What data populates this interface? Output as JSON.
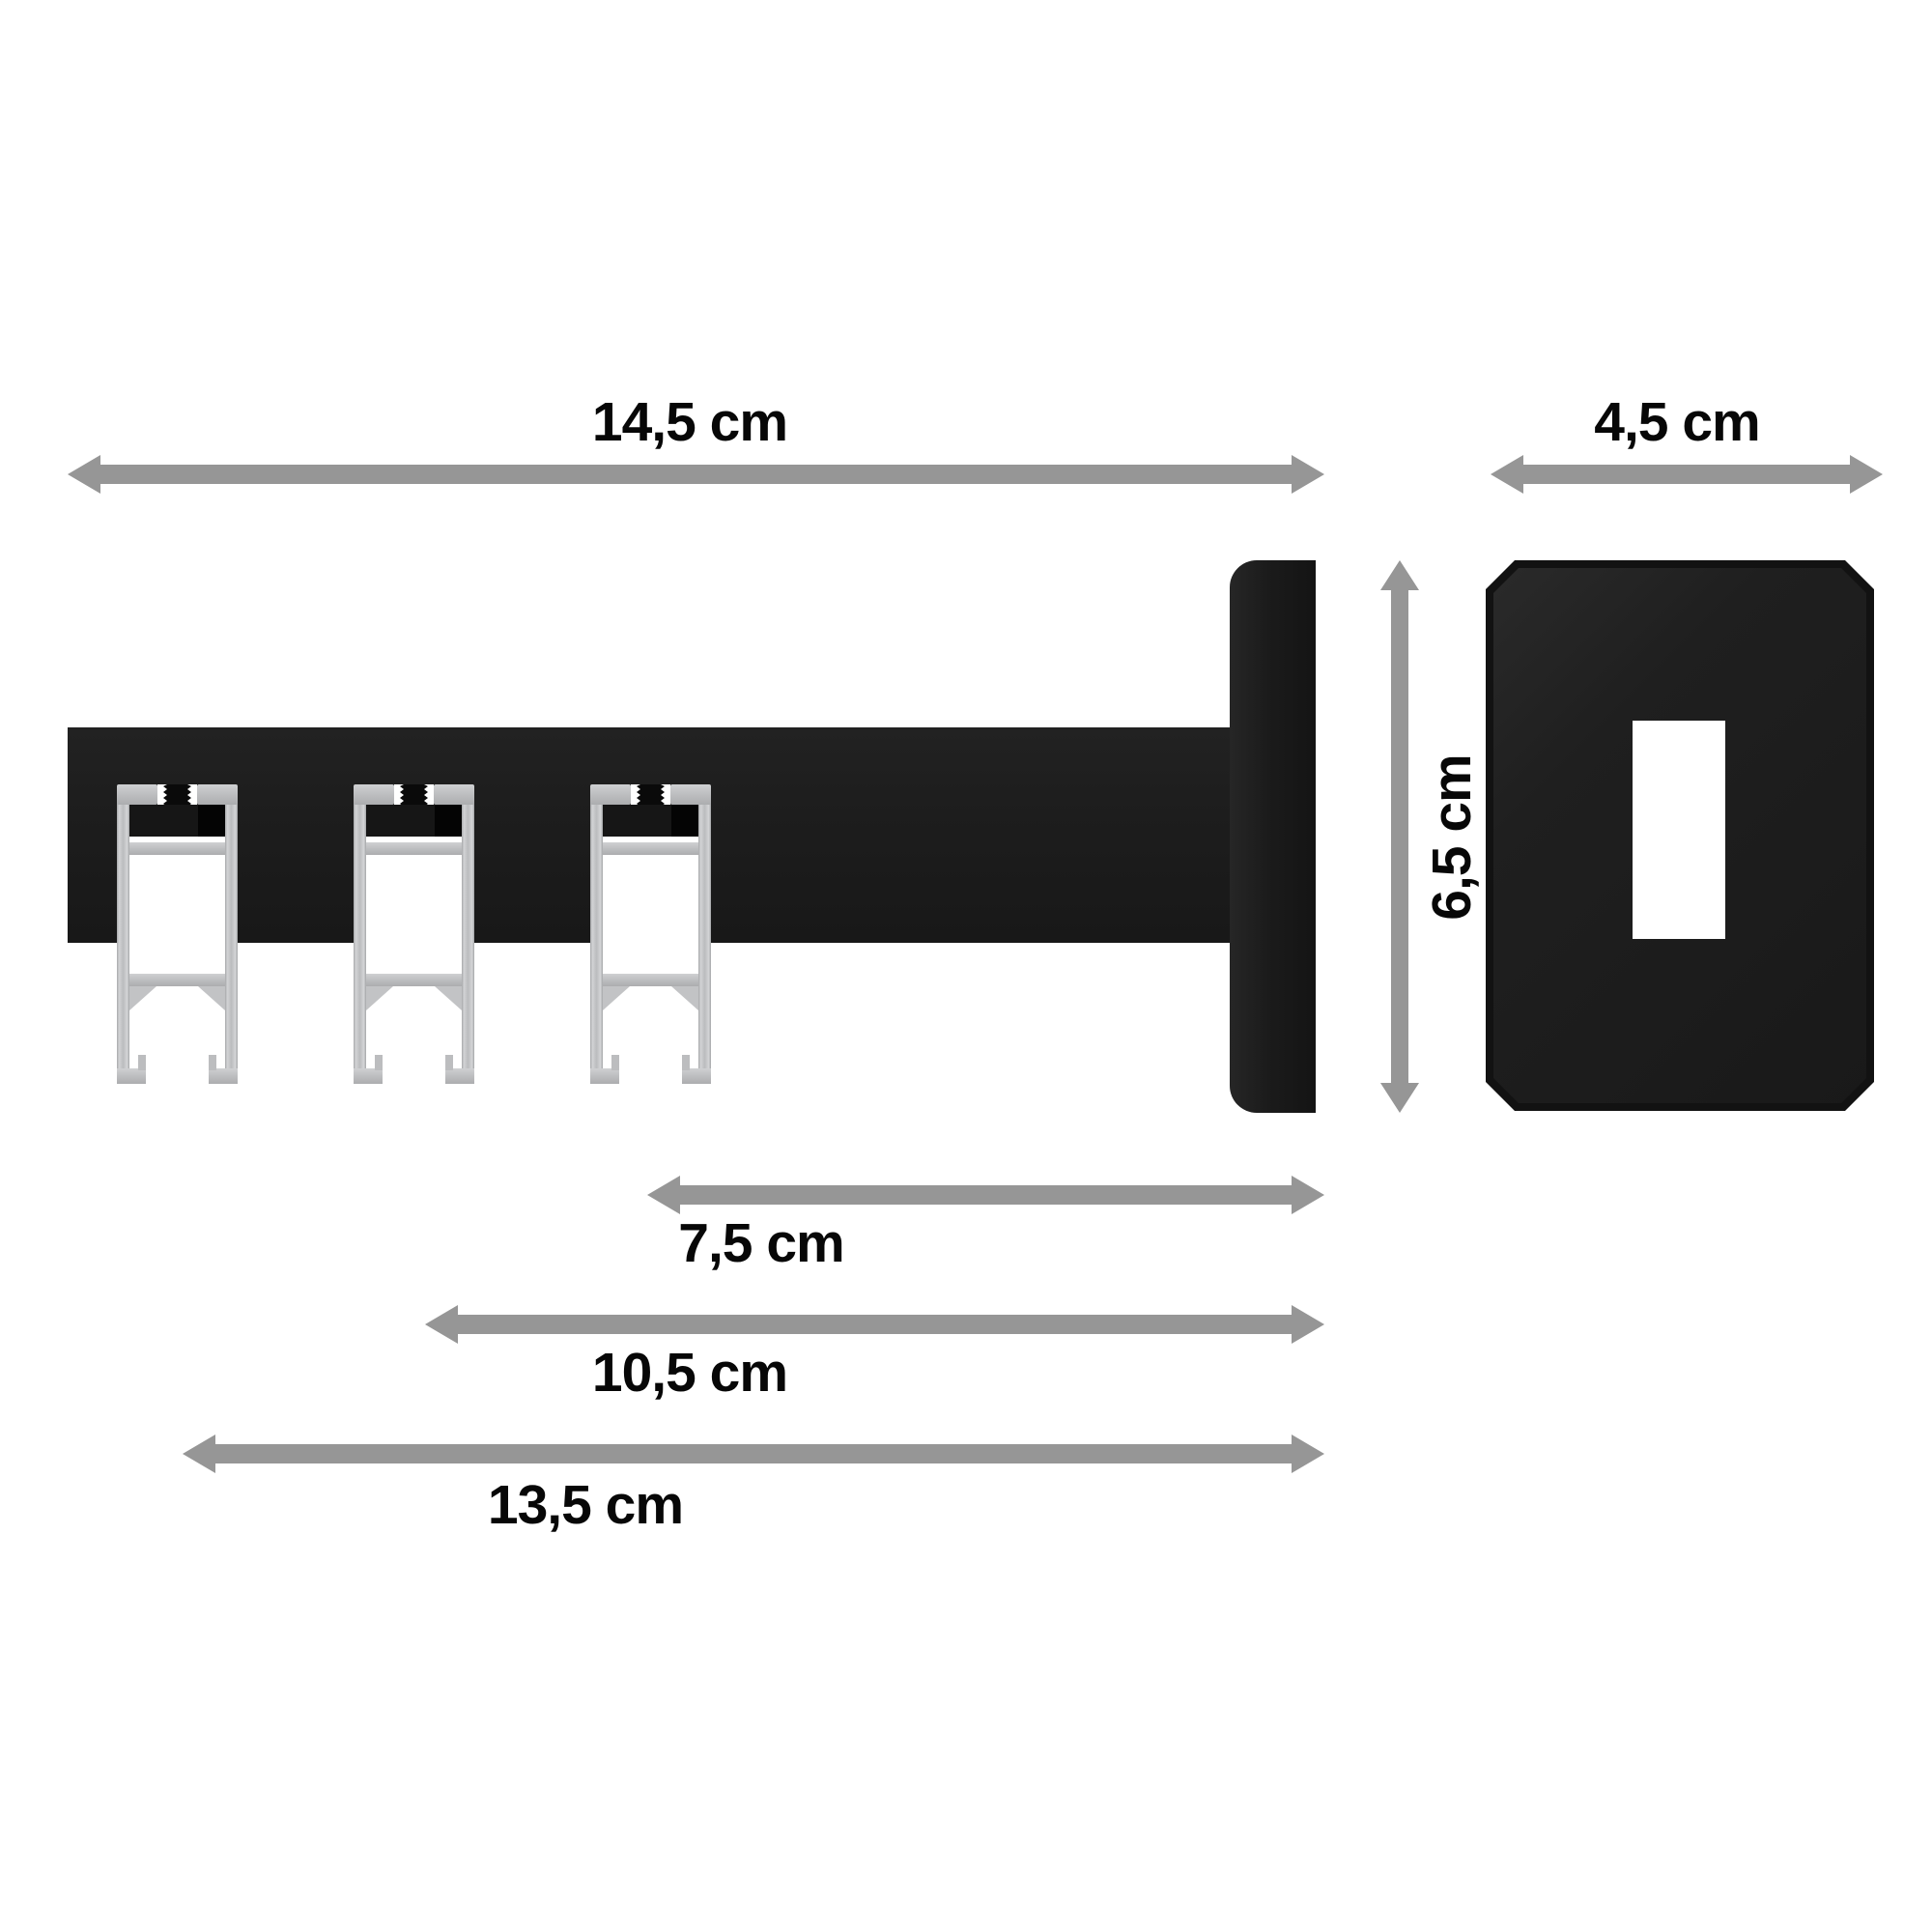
{
  "diagram": {
    "title": "curtain-rail wall bracket dimension drawing",
    "labels": {
      "total_length": "14,5 cm",
      "plate_width": "4,5 cm",
      "plate_height": "6,5 cm",
      "distance_1": "7,5 cm",
      "distance_2": "10,5 cm",
      "distance_3": "13,5 cm"
    },
    "colors": {
      "background": "#ffffff",
      "arrow": "#969696",
      "text": "#070707",
      "part_black": "#1d1d1d",
      "aluminum": "#c3c4c6"
    },
    "parts": {
      "carrier": "bracket carrier profile (side view)",
      "rails": [
        "rail track profile 1",
        "rail track profile 2",
        "rail track profile 3"
      ],
      "side_plate": "wall plate (side view)",
      "front_plate": "wall plate (front view)",
      "front_hole": "mounting hole"
    }
  }
}
